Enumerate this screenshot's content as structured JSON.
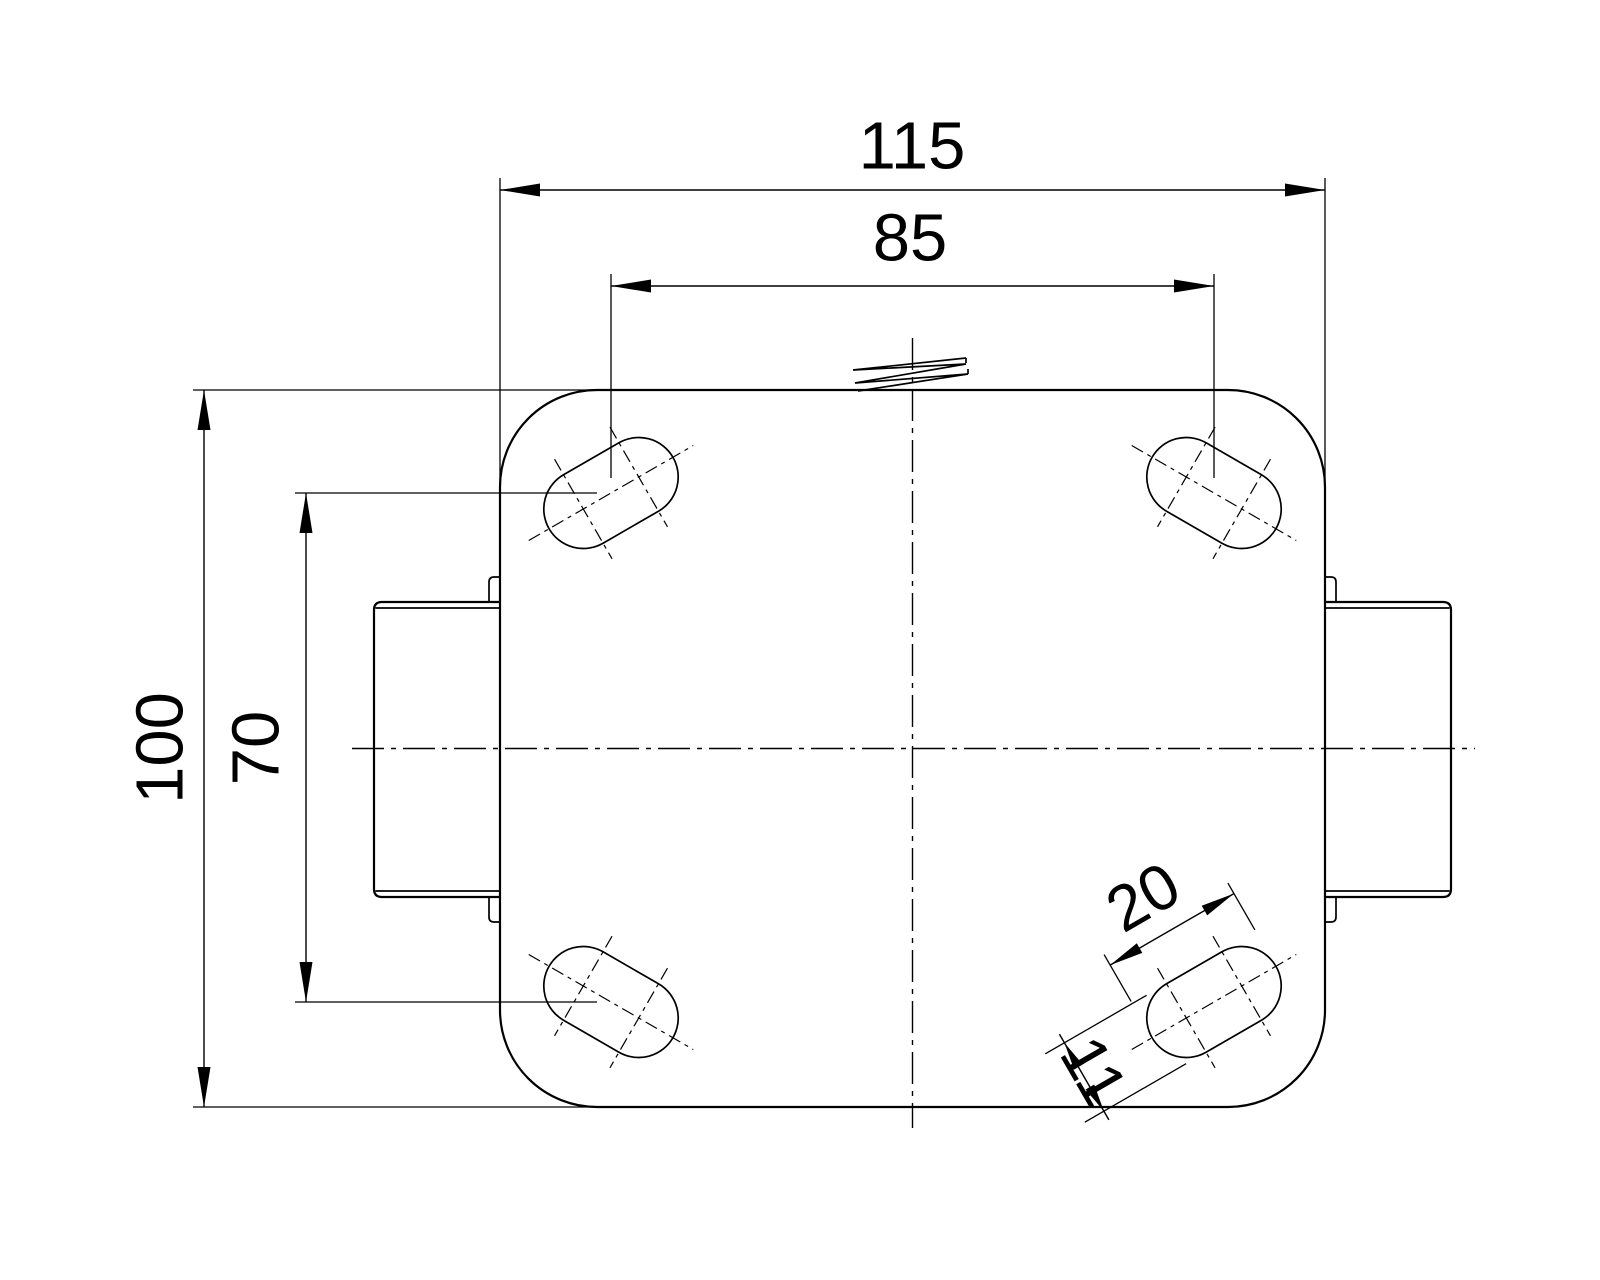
{
  "drawing": {
    "kind": "caster-plate-top-view-technical-drawing",
    "dimensions": {
      "plate_width": "115",
      "hole_spacing_width": "85",
      "plate_depth": "100",
      "hole_spacing_depth": "70",
      "slot_length": "20",
      "slot_width": "11"
    }
  }
}
